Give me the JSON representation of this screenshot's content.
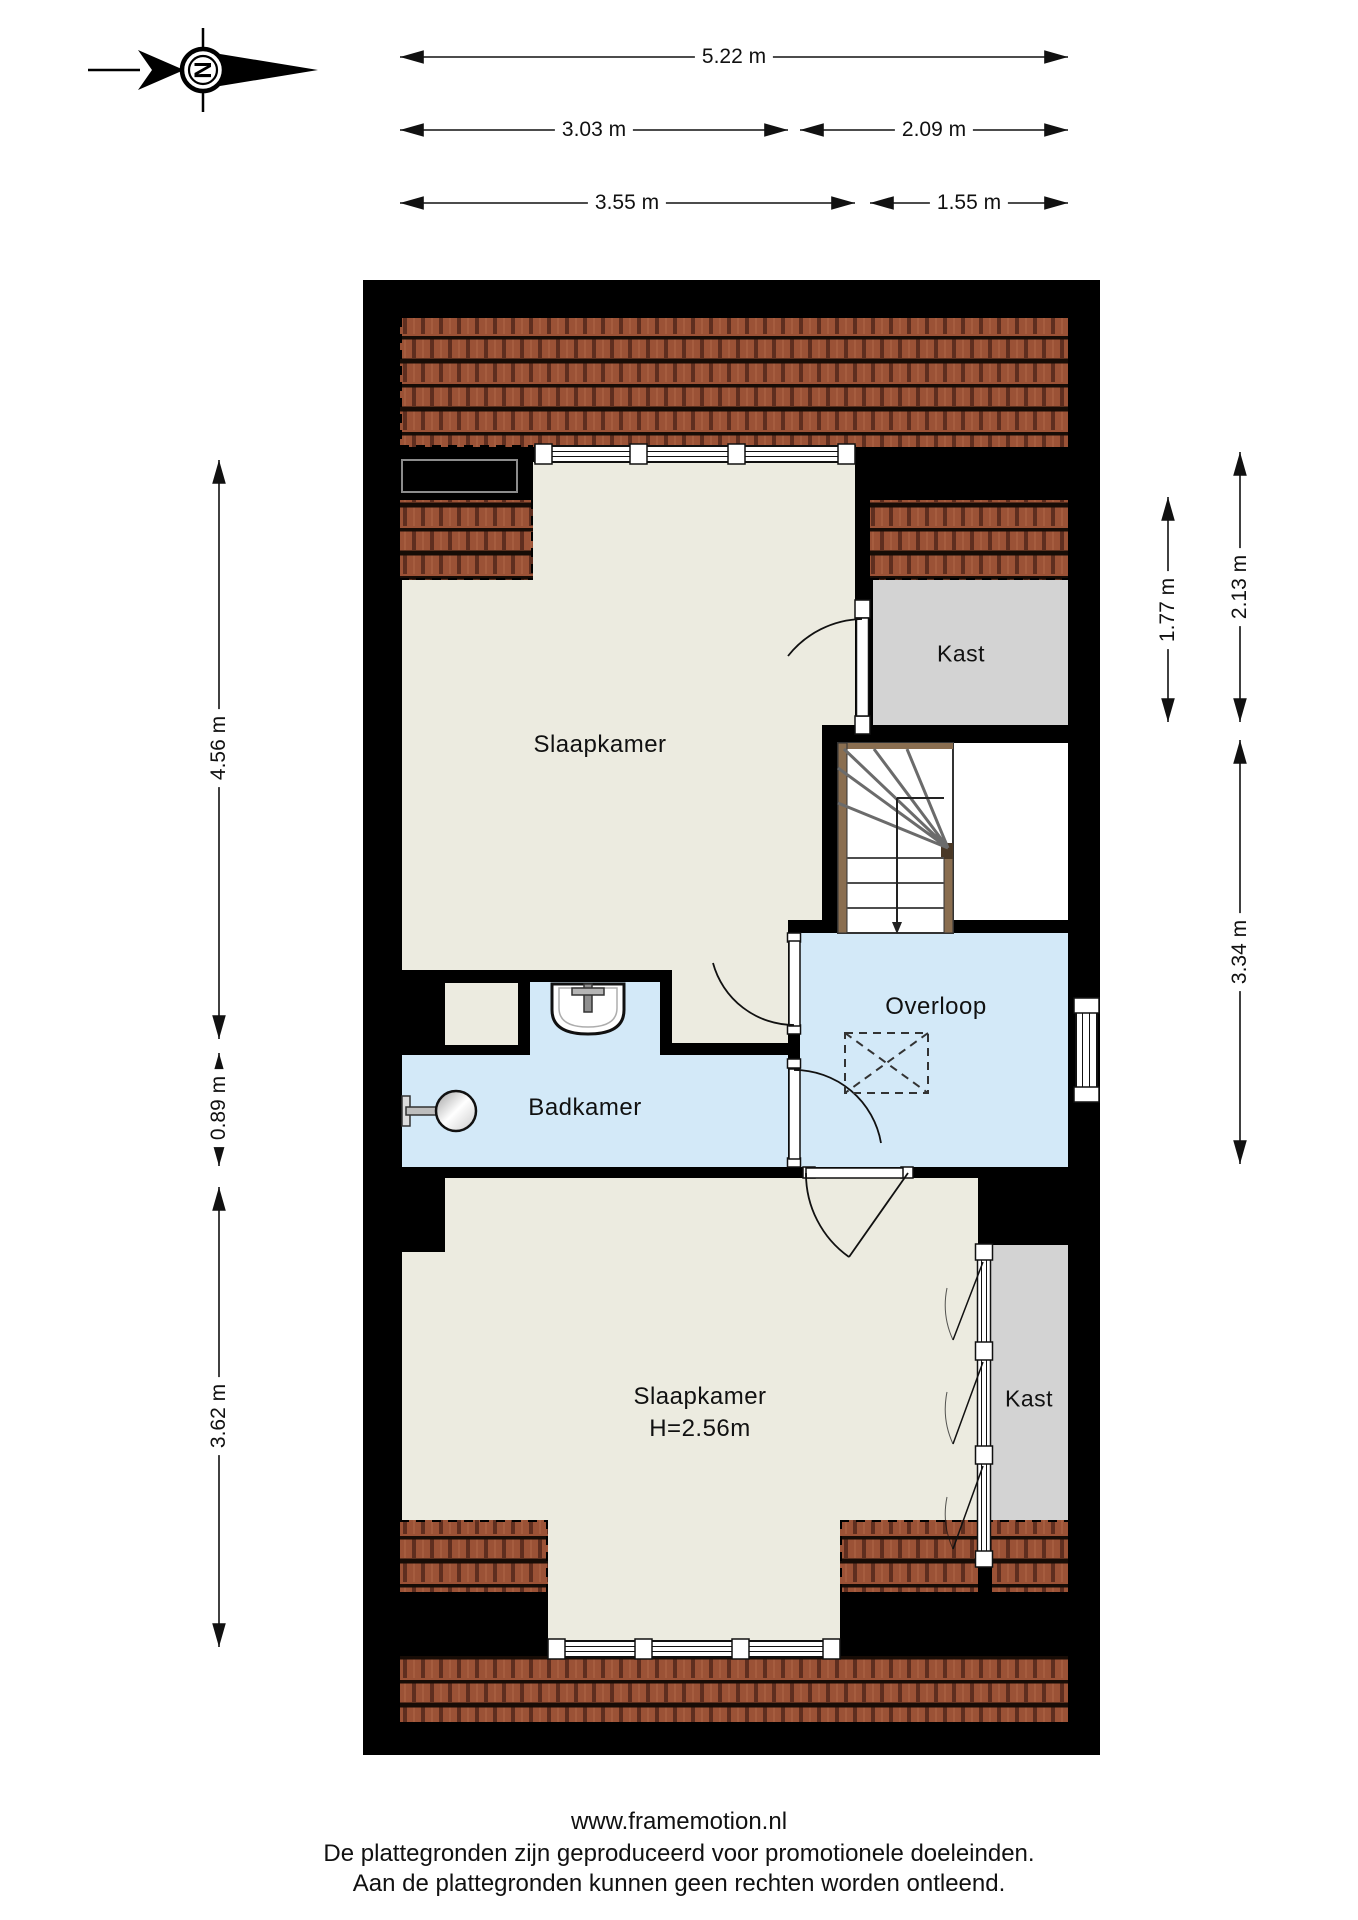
{
  "compass": {
    "letter": "N"
  },
  "dimensions": {
    "top": [
      {
        "label": "5.22 m"
      },
      {
        "label": "3.03 m"
      },
      {
        "label": "2.09 m"
      },
      {
        "label": "3.55 m"
      },
      {
        "label": "1.55 m"
      }
    ],
    "left": [
      {
        "label": "4.56 m"
      },
      {
        "label": "0.89 m"
      },
      {
        "label": "3.62 m"
      }
    ],
    "right": [
      {
        "label": "1.77 m"
      },
      {
        "label": "2.13 m"
      },
      {
        "label": "3.34 m"
      }
    ]
  },
  "rooms": {
    "bedroom_top": "Slaapkamer",
    "closet_top": "Kast",
    "bathroom": "Badkamer",
    "landing": "Overloop",
    "bedroom_bottom_line1": "Slaapkamer",
    "bedroom_bottom_line2": "H=2.56m",
    "closet_bottom": "Kast"
  },
  "footer": {
    "website": "www.framemotion.nl",
    "disclaimer_line1": "De plattegronden zijn geproduceerd voor promotionele doeleinden.",
    "disclaimer_line2": "Aan de plattegronden kunnen geen rechten worden ontleend."
  },
  "colors": {
    "wall_black": "#000000",
    "floor_beige": "#ecebe0",
    "room_blue": "#d3e9f8",
    "closet_gray": "#d3d3d3",
    "tile_red": "#9b5236",
    "stair_wood": "#8a6e50"
  }
}
